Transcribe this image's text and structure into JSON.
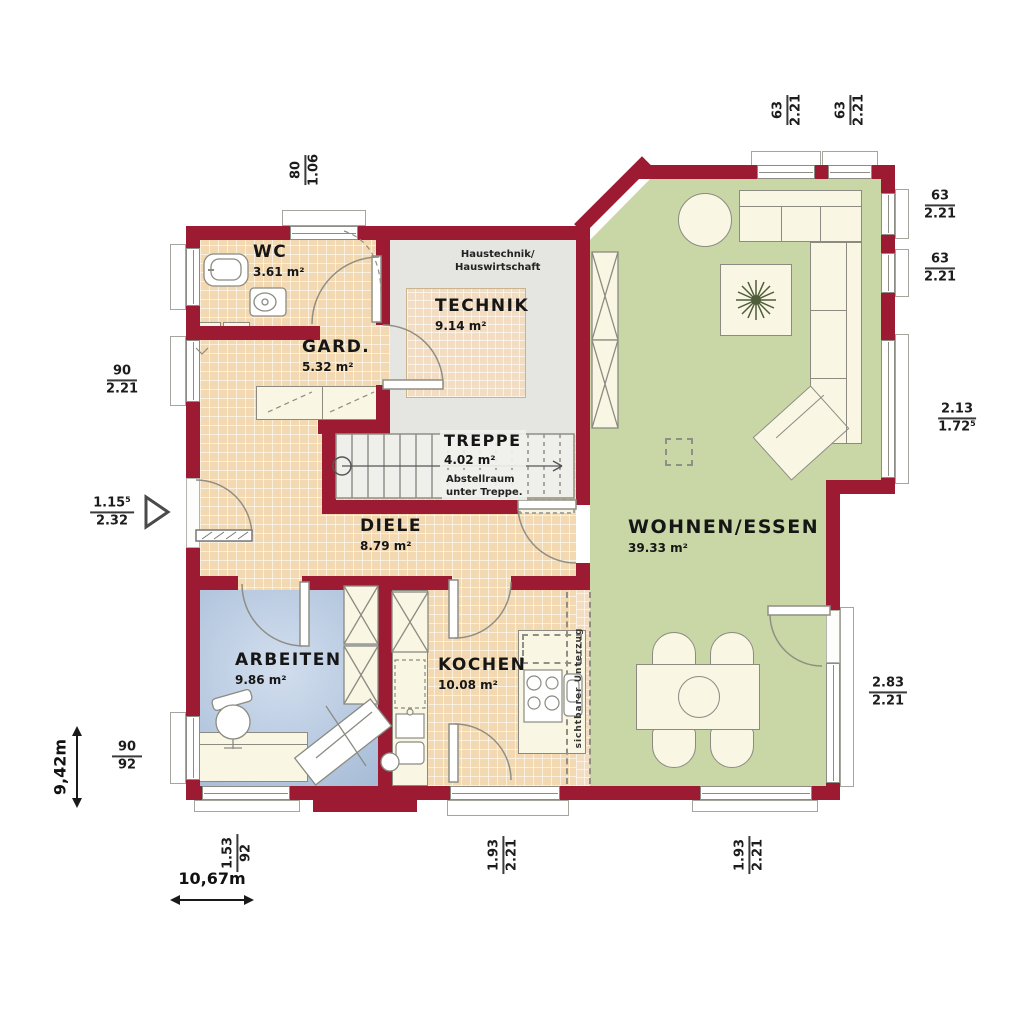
{
  "rooms": {
    "wc": {
      "name": "WC",
      "area": "3.61 m²"
    },
    "gard": {
      "name": "GARD.",
      "area": "5.32 m²"
    },
    "technik": {
      "name": "TECHNIK",
      "area": "9.14 m²"
    },
    "treppe": {
      "name": "TREPPE",
      "area": "4.02 m²"
    },
    "diele": {
      "name": "DIELE",
      "area": "8.79 m²"
    },
    "arbeiten": {
      "name": "ARBEITEN",
      "area": "9.86 m²"
    },
    "kochen": {
      "name": "KOCHEN",
      "area": "10.08 m²"
    },
    "wohnen": {
      "name": "WOHNEN/ESSEN",
      "area": "39.33 m²"
    }
  },
  "notes": {
    "technik1": "Haustechnik/",
    "technik2": "Hauswirtschaft",
    "treppe1": "Abstellraum",
    "treppe2": "unter Treppe.",
    "beam": "sichtbarer Unterzug"
  },
  "dims": {
    "top": [
      {
        "a": "80",
        "b": "1.06"
      },
      {
        "a": "63",
        "b": "2.21"
      },
      {
        "a": "63",
        "b": "2.21"
      }
    ],
    "right": [
      {
        "a": "63",
        "b": "2.21"
      },
      {
        "a": "63",
        "b": "2.21"
      },
      {
        "a": "2.13",
        "b": "1.72⁵"
      },
      {
        "a": "2.83",
        "b": "2.21"
      }
    ],
    "left": [
      {
        "a": "90",
        "b": "2.21"
      },
      {
        "a": "1.15⁵",
        "b": "2.32"
      },
      {
        "a": "90",
        "b": "92"
      }
    ],
    "bottom": [
      {
        "a": "1.53",
        "b": "92"
      },
      {
        "a": "1.93",
        "b": "2.21"
      },
      {
        "a": "1.93",
        "b": "2.21"
      }
    ]
  },
  "overall": {
    "height": "9,42m",
    "width": "10,67m"
  },
  "colors": {
    "wall": "#9c1b33",
    "tile": "#f3d9b2",
    "living": "#c9d7a6",
    "work": "#b7c9e0",
    "technik": "#e5e5e1"
  }
}
